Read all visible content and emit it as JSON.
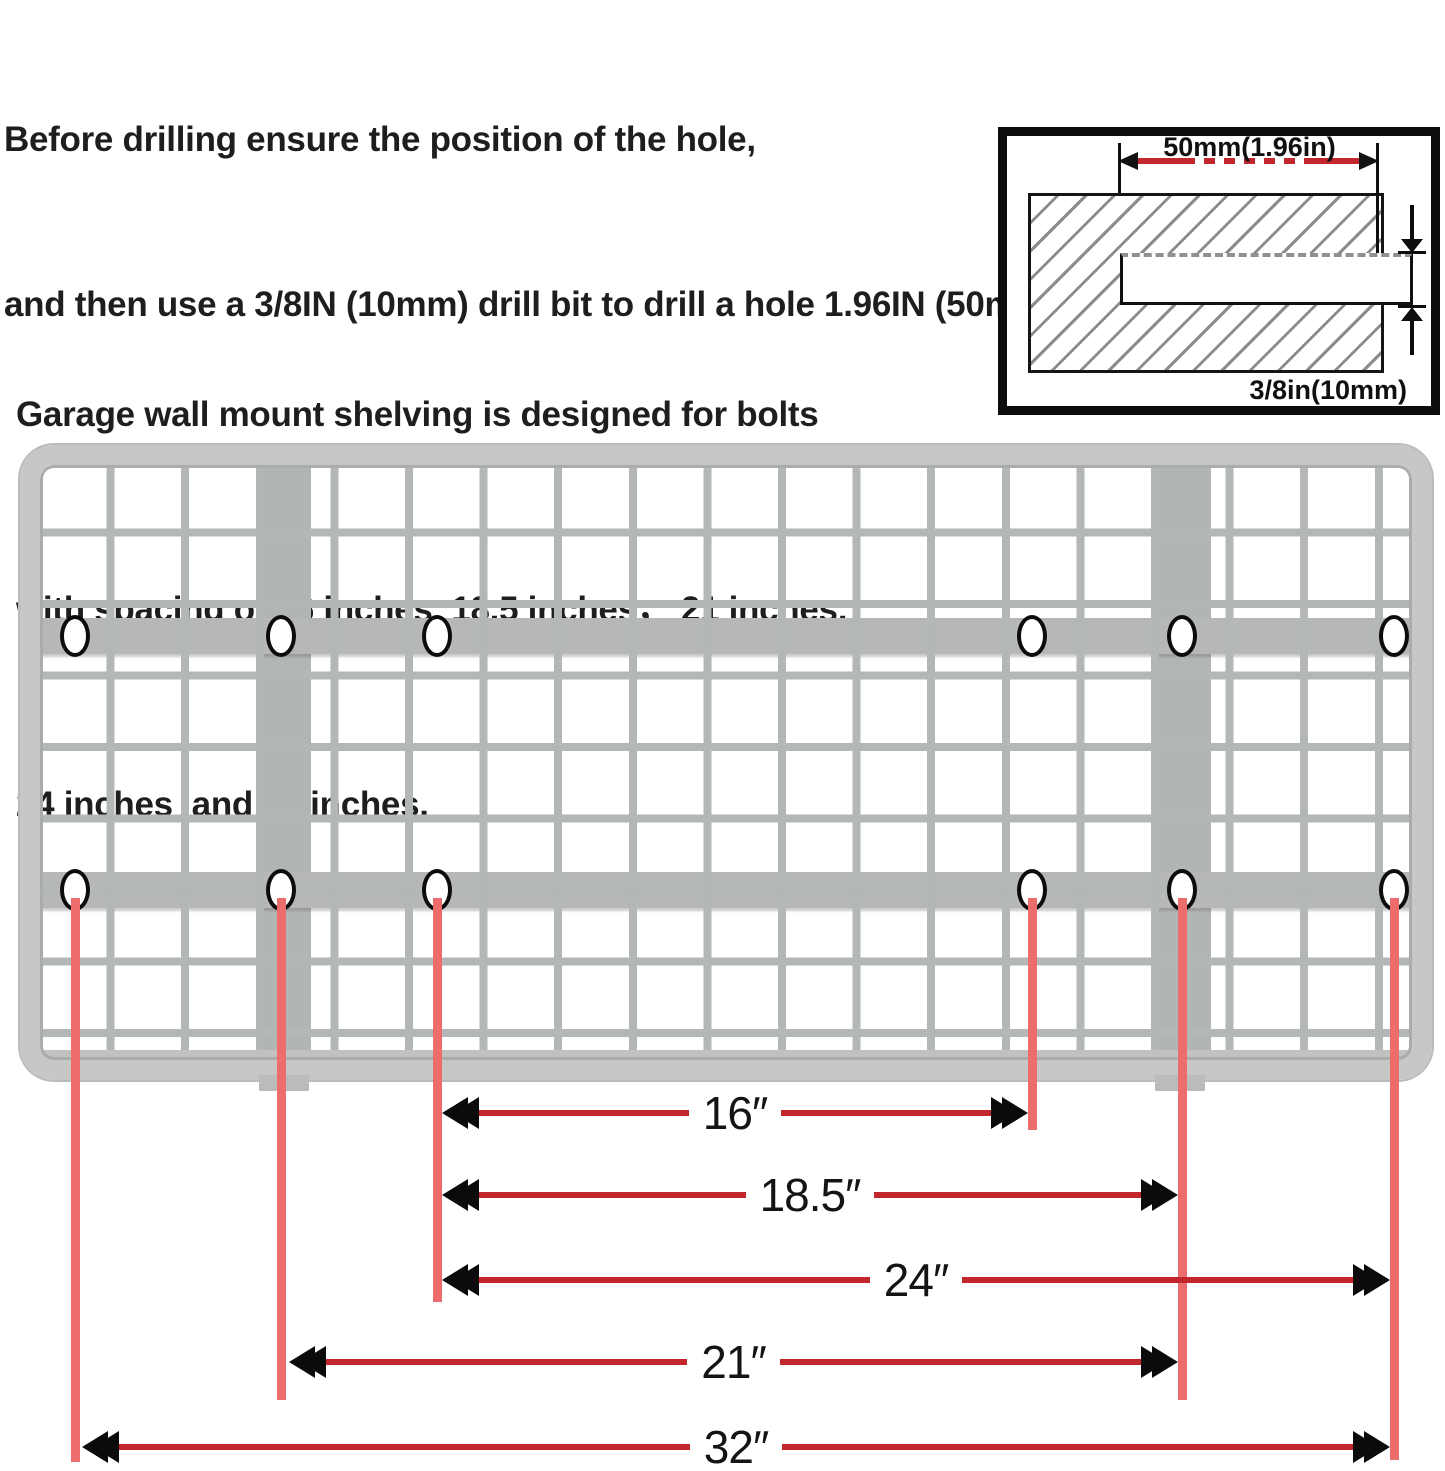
{
  "header": {
    "line1": "Before drilling ensure the position of the hole,",
    "line2": "and then use a 3/8IN (10mm) drill bit to drill a hole 1.96IN (50mm) deep."
  },
  "paragraph": {
    "line1": "Garage wall mount shelving is designed for bolts",
    "line2": "with spacing of 16 inches, 18.5 inches， 21 inches,",
    "line3": "24 inches  and 32 inches."
  },
  "inset": {
    "depth_label": "50mm(1.96in)",
    "diameter_label": "3/8in(10mm)"
  },
  "measurements": [
    {
      "label": "16″",
      "inches": 16
    },
    {
      "label": "18.5″",
      "inches": 18.5
    },
    {
      "label": "24″",
      "inches": 24
    },
    {
      "label": "21″",
      "inches": 21
    },
    {
      "label": "32″",
      "inches": 32
    }
  ],
  "colors": {
    "guide_line_red": "#ed6d6d",
    "dimension_red": "#c1272d",
    "shelf_gray": "#b6b9b7"
  }
}
